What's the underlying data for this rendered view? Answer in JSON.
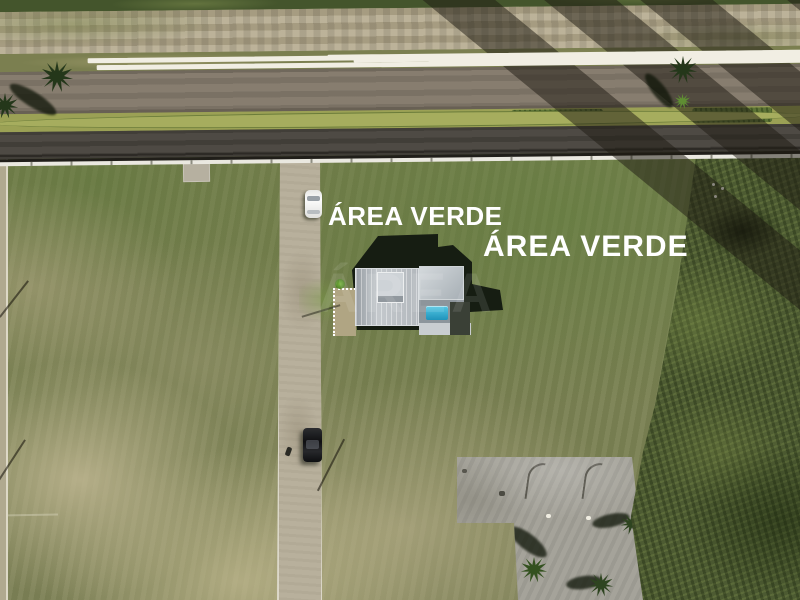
{
  "photo": {
    "overlay_labels": {
      "left": "ÁREA VERDE",
      "right": "ÁREA VERDE"
    },
    "watermark_text": "ÁREA",
    "colors": {
      "label_text": "#ffffff",
      "pool_water": "#2fa9cc",
      "house_roof": "#b9bec2",
      "field_green": "#74814c",
      "field_dry": "#b2a883",
      "scrub_green": "#4d5b32",
      "road_upper_asphalt": "#877d6f",
      "road_lower_asphalt": "#4e4a44",
      "median_grass": "#9ba155",
      "promenade_paver": "#b3a88b",
      "gravel_path": "#b8b09c",
      "concrete_pavement": "#a5a39a",
      "fence_white": "#eae8e0",
      "palm_crown": "#2e4420",
      "white_car": "#f2f2f1",
      "black_car": "#17181a"
    }
  }
}
